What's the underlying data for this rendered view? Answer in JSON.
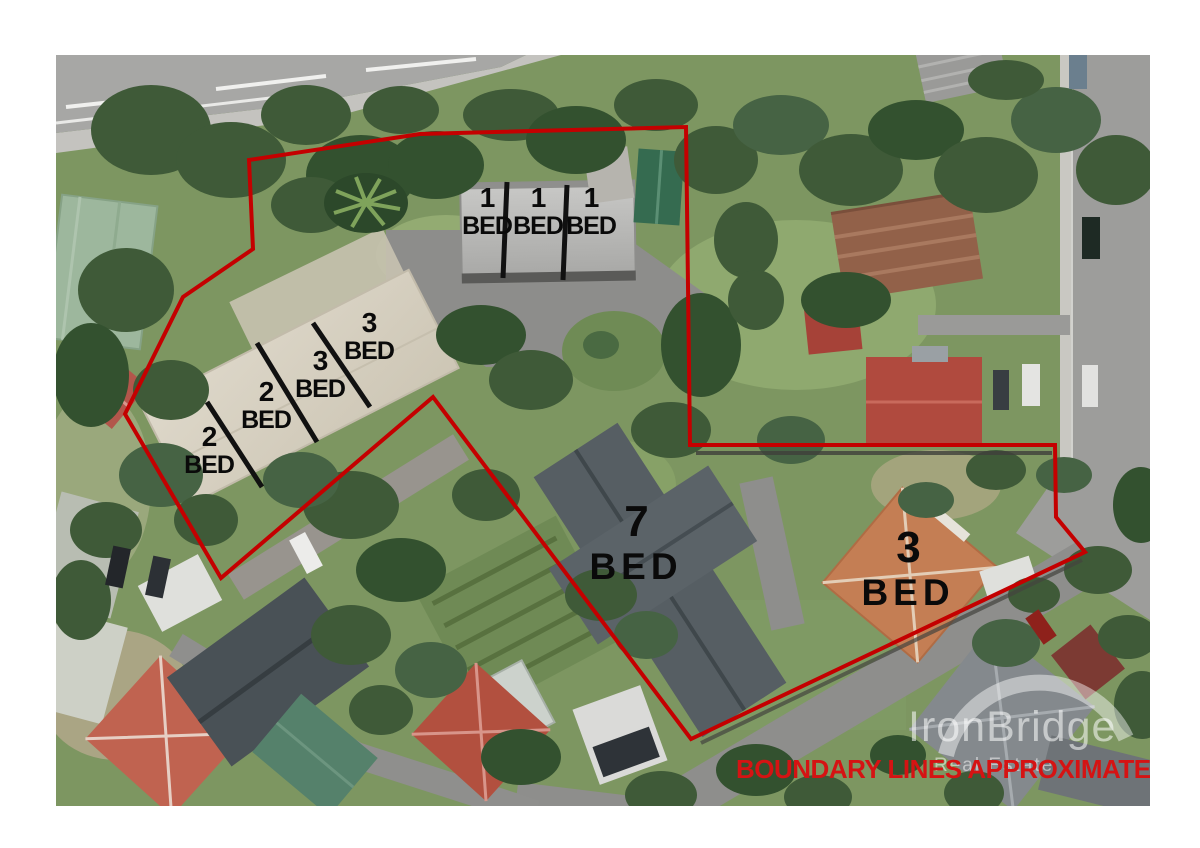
{
  "photo": {
    "description": "Aerial photograph of a residential block with red property boundary overlay",
    "boundary_note": "BOUNDARY LINES APPROXIMATE"
  },
  "watermark": {
    "brand": "IronBridge",
    "tagline": "Real Estate"
  },
  "units": [
    {
      "id": "unit-1-bed-a",
      "beds": "1",
      "word": "BED"
    },
    {
      "id": "unit-1-bed-b",
      "beds": "1",
      "word": "BED"
    },
    {
      "id": "unit-1-bed-c",
      "beds": "1",
      "word": "BED"
    },
    {
      "id": "unit-2-bed-a",
      "beds": "2",
      "word": "BED"
    },
    {
      "id": "unit-2-bed-b",
      "beds": "2",
      "word": "BED"
    },
    {
      "id": "unit-3-bed-a",
      "beds": "3",
      "word": "BED"
    },
    {
      "id": "unit-3-bed-b",
      "beds": "3",
      "word": "BED"
    },
    {
      "id": "unit-7-bed-house",
      "beds": "7",
      "word": "BED"
    },
    {
      "id": "unit-3-bed-house",
      "beds": "3",
      "word": "BED"
    }
  ],
  "colors": {
    "boundary_line": "#c40000",
    "unit_divider": "#111111",
    "note_text": "#d51313",
    "label_text": "#0a0a0a",
    "watermark_white": "rgba(255,255,255,0.55)"
  }
}
